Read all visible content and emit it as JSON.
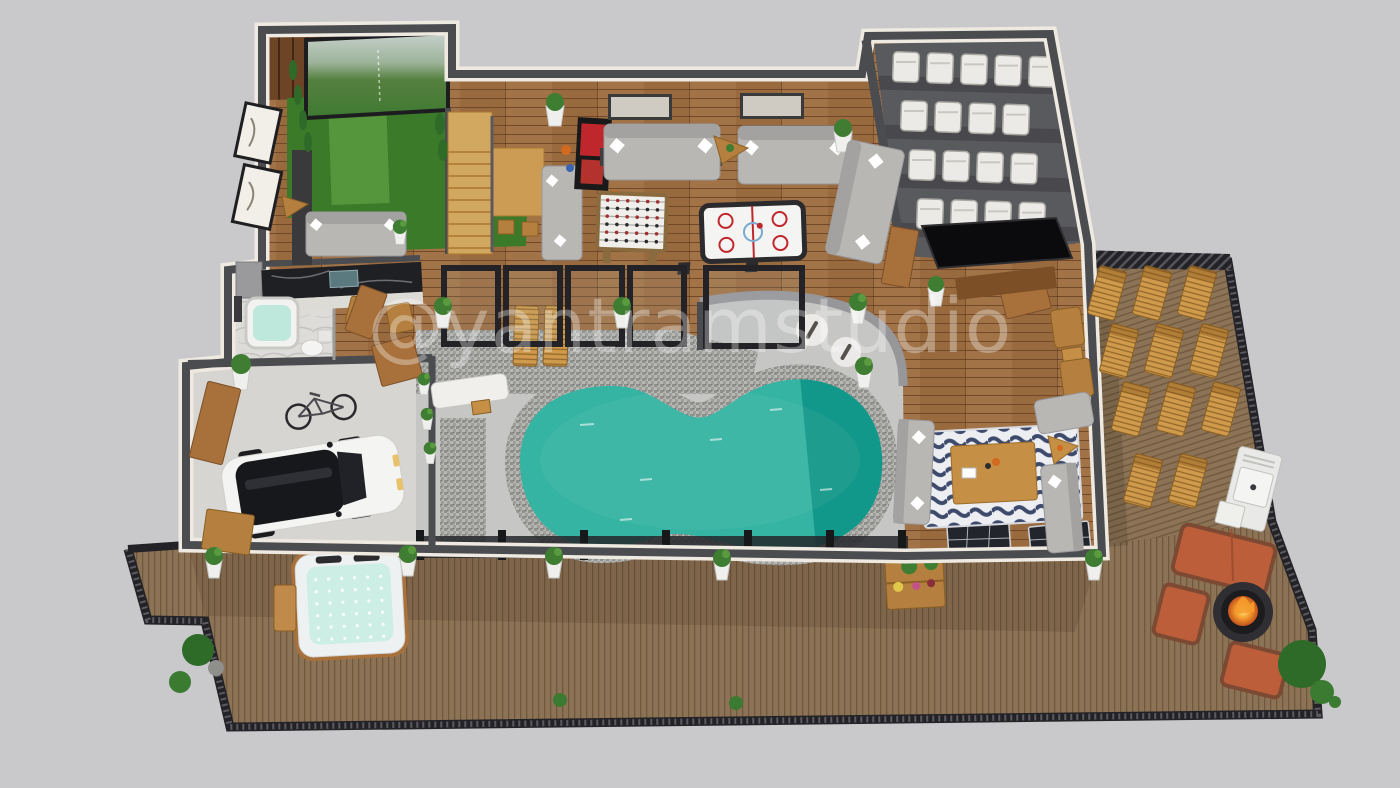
{
  "watermark": {
    "text": "@yantramstudio"
  },
  "scene": {
    "type": "3d-floor-plan-rendering",
    "view": "isometric-top-down",
    "areas": [
      {
        "name": "golf-simulator-room"
      },
      {
        "name": "game-lounge"
      },
      {
        "name": "home-theater"
      },
      {
        "name": "bar-kitchenette"
      },
      {
        "name": "bathroom"
      },
      {
        "name": "garage"
      },
      {
        "name": "indoor-pool-patio"
      },
      {
        "name": "zebra-rug-lounge"
      },
      {
        "name": "sun-lounger-deck"
      },
      {
        "name": "fire-pit-lounge"
      },
      {
        "name": "hot-tub-deck"
      }
    ]
  },
  "counts": {
    "theater_seats_per_row": [
      5,
      4,
      4,
      4
    ],
    "deck_lounger_rows": [
      3,
      3,
      3,
      2
    ],
    "patio_pergola_frames": 4,
    "hot_tub_jet_grid": [
      6,
      6
    ],
    "pool_side_white_chairs": 2,
    "fire_pit_armchairs": 2,
    "gray_sofas": 7
  },
  "palette": {
    "background": "#c9c9cc",
    "wall": "#4b4c50",
    "wall_face": "#efeae1",
    "wood_floor": "#9a6a3f",
    "wood_dark": "#6e4426",
    "deck": "#8d7355",
    "patio": "#c6c6c4",
    "mosaic": "#a9a9a7",
    "pool_shallow": "#35b4a3",
    "pool_deep": "#12988a",
    "turf": "#3a7a28",
    "turf_light": "#5a9b3f",
    "sofa_gray": "#b8b7b4",
    "seat_white": "#eceae6",
    "theater_floor": "#595a5e",
    "lounger_wood": "#cf9a4b",
    "outdoor_sofa": "#bd5e3a",
    "fire": "#f59b2d",
    "hot_tub_water": "#cdeee4",
    "plant": "#3f7d33",
    "rug_navy": "#3d4a6b",
    "stone": "#b3a288",
    "concrete": "#d7d5d1"
  }
}
